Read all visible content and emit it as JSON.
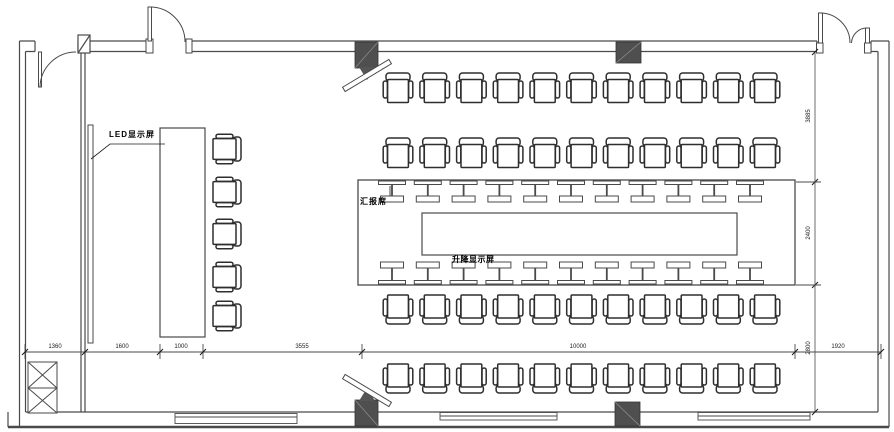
{
  "drawing": {
    "type": "conference-room-floor-plan",
    "labels": {
      "led_screen": "LED显示屏",
      "presenter_seat": "汇报席",
      "lifting_screen": "升降显示屏"
    },
    "dimensions": {
      "bottom": [
        "1360",
        "1600",
        "1000",
        "3555",
        "10000",
        "1920"
      ],
      "right": [
        "3885",
        "2400",
        "2800"
      ]
    },
    "colors": {
      "line": "#4a4a4a",
      "chair_line": "#2e2e2e",
      "speaker_fill": "#4f4f4f"
    },
    "furniture": {
      "audience_rows": 4,
      "chairs_per_row": 11,
      "side_chairs": 5,
      "table_mic_units_per_side": 11,
      "wall_speakers": 4,
      "shaft_boxes": 2,
      "bottom_wall_cabinets": 3
    }
  }
}
